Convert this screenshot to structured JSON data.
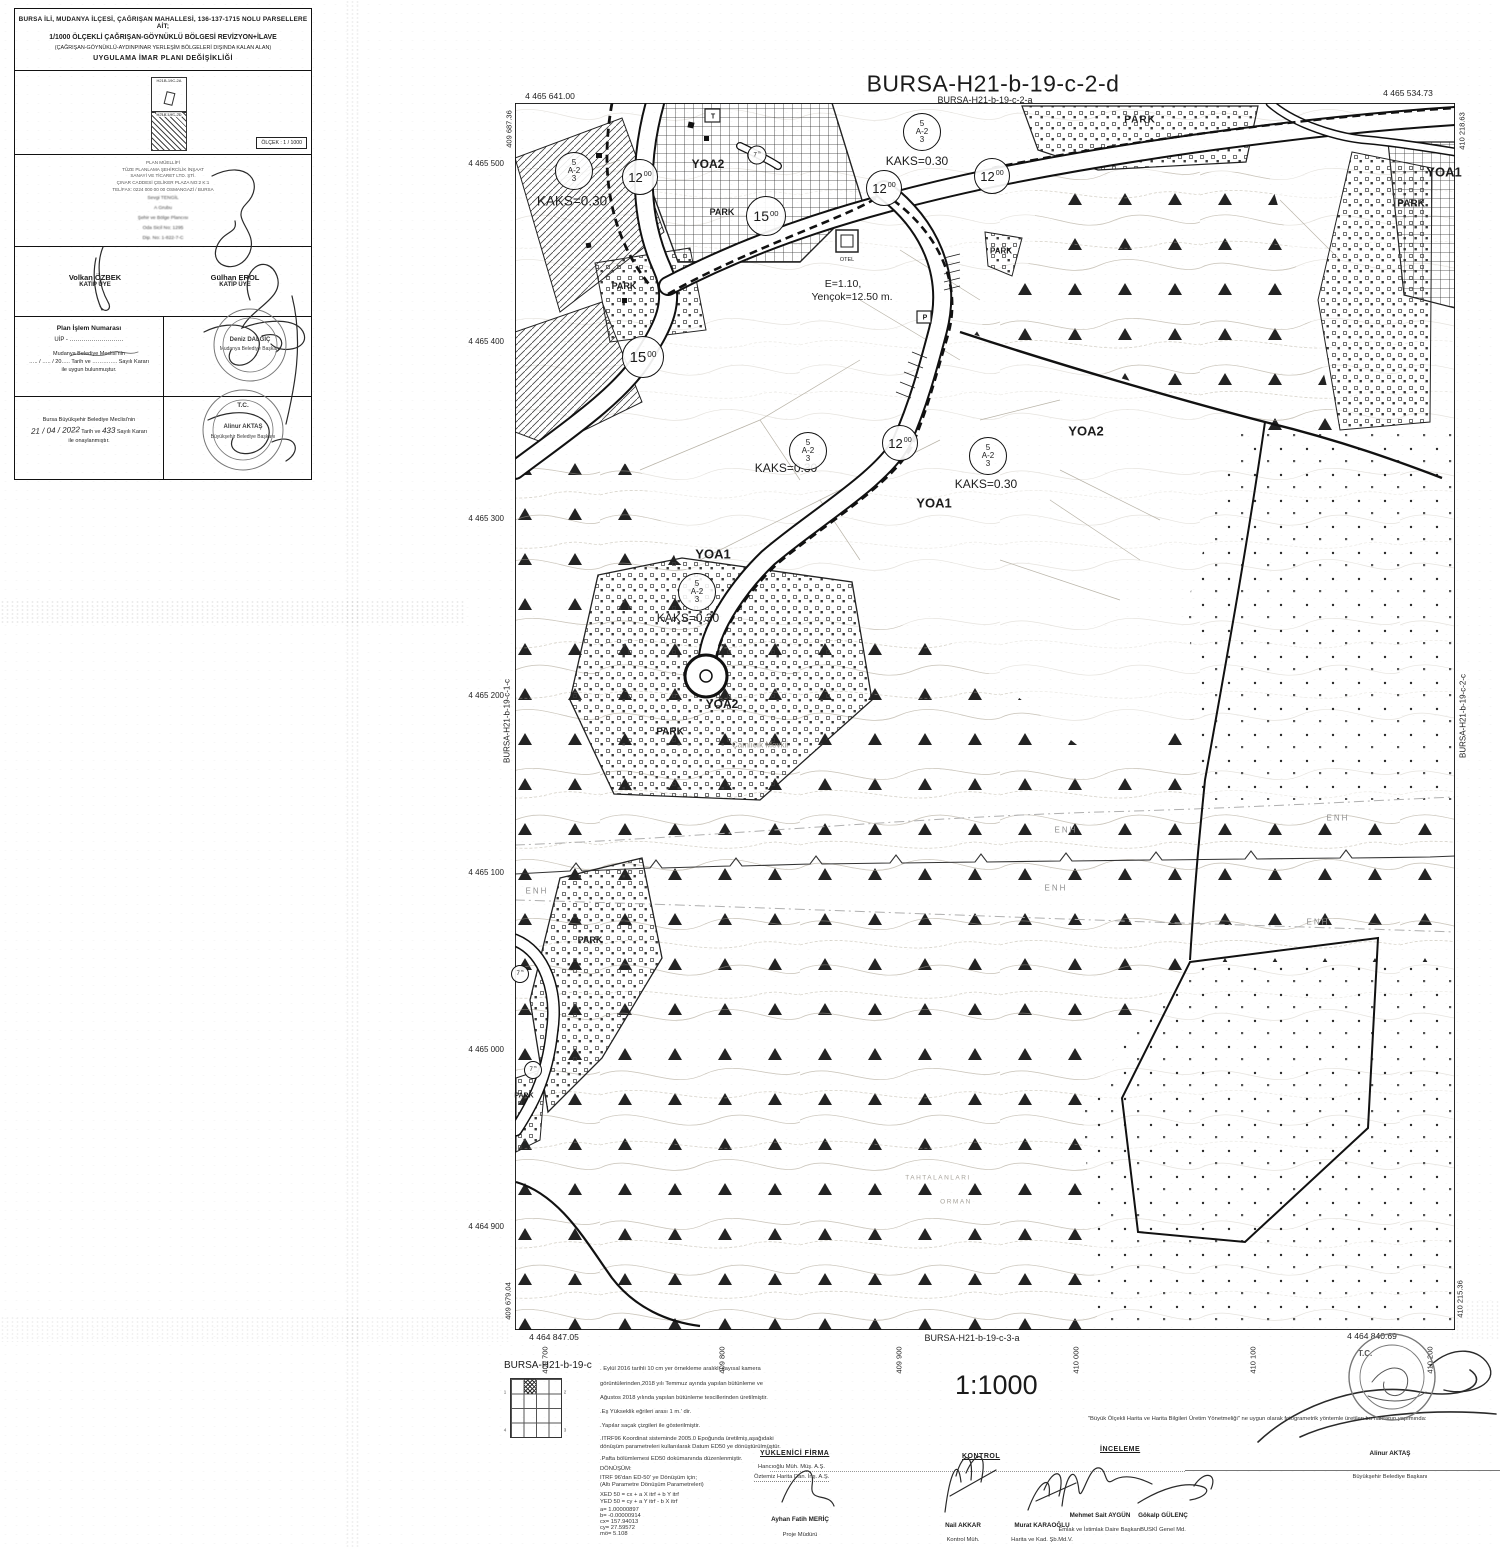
{
  "title_block": {
    "header_lines": [
      "BURSA İLİ, MUDANYA İLÇESİ, ÇAĞRIŞAN MAHALLESİ, 136-137-1715 NOLU PARSELLERE AİT;",
      "1/1000 ÖLÇEKLİ ÇAĞRIŞAN-GÖYNÜKLÜ BÖLGESİ REVİZYON+İLAVE",
      "(ÇAĞRIŞAN-GÖYNÜKLÜ-AYDINPINAR YERLEŞİM BÖLGELERİ DIŞINDA KALAN ALAN)",
      "UYGULAMA İMAR PLANI DEĞİŞİKLİĞİ"
    ],
    "index_labels": [
      "H21B-19C-2A",
      "H21B-19C-2D"
    ],
    "scale_box": "ÖLÇEK : 1 / 1000",
    "author_lines": [
      "PLAN MÜELLİFİ",
      "TÜZE PLANLAMA ŞEHİRCİLİK İNŞAAT",
      "SANAYİ VE TİCARET LTD. ŞTİ.",
      "ÇINAR CADDESİ ÇELİKER PLAZA NO:2 K:1",
      "TEL/FAX: 0224 000 00 00  OSMANGAZİ / BURSA"
    ],
    "author_name_lines": [
      "Sevgi TENGİL",
      "A Grubu",
      "Şehir ve Bölge Plancısı",
      "Oda Sicil No: 1295",
      "Dip. No: 1-822-7-C"
    ],
    "members": [
      {
        "name": "Volkan ÖZBEK",
        "role": "KATİP ÜYE"
      },
      {
        "name": "Gülhan EROL",
        "role": "KATİP ÜYE"
      }
    ],
    "plan_no": {
      "title": "Plan İşlem Numarası",
      "uip": "UİP - ………………………",
      "l1": "Mudanya Belediye Meclisi'nin",
      "l2": "….. / ….. / 20….. Tarih ve ………….. Sayılı Kararı",
      "l3": "ile uygun bulunmuştur."
    },
    "mudanya_stamp": {
      "name": "Deniz DALGIÇ",
      "title": "Mudanya Belediye Başkanı"
    },
    "approval": {
      "l1": "Bursa Büyükşehir Belediye Meclisi'nin",
      "date": "21 / 04 / 2022",
      "mid": "Tarih ve",
      "num": "433",
      "tail": "Sayılı Kararı",
      "l3": "ile onaylanmıştır."
    },
    "bursa_stamp": {
      "tc": "T.C.",
      "name": "Alinur AKTAŞ",
      "title": "Büyükşehir Belediye Başkanı"
    }
  },
  "map": {
    "title": "BURSA-H21-b-19-c-2-d",
    "zone_symbol": {
      "top": "5",
      "mid": "A-2",
      "bot": "3"
    },
    "zone_circles": [
      {
        "x": 574,
        "y": 171
      },
      {
        "x": 922,
        "y": 132
      },
      {
        "x": 808,
        "y": 451
      },
      {
        "x": 988,
        "y": 456
      },
      {
        "x": 697,
        "y": 592
      }
    ],
    "road_circles": [
      {
        "t": "12",
        "sup": "00",
        "x": 640,
        "y": 177,
        "d": 34,
        "fs": 13
      },
      {
        "t": "12",
        "sup": "00",
        "x": 884,
        "y": 188,
        "d": 34,
        "fs": 13
      },
      {
        "t": "12",
        "sup": "00",
        "x": 992,
        "y": 176,
        "d": 34,
        "fs": 13
      },
      {
        "t": "12",
        "sup": "00",
        "x": 900,
        "y": 443,
        "d": 34,
        "fs": 13
      },
      {
        "t": "15",
        "sup": "00",
        "x": 766,
        "y": 216,
        "d": 38,
        "fs": 14
      },
      {
        "t": "15",
        "sup": "00",
        "x": 643,
        "y": 357,
        "d": 40,
        "fs": 15
      },
      {
        "t": "7",
        "sup": "m",
        "x": 757,
        "y": 155,
        "d": 17,
        "fs": 6
      },
      {
        "t": "7",
        "sup": "m",
        "x": 520,
        "y": 974,
        "d": 16,
        "fs": 6
      },
      {
        "t": "7",
        "sup": "m",
        "x": 533,
        "y": 1070,
        "d": 16,
        "fs": 6
      }
    ],
    "left_coords": [
      {
        "t": "4 465 500",
        "y": 164
      },
      {
        "t": "4 465 400",
        "y": 342
      },
      {
        "t": "4 465 300",
        "y": 519
      },
      {
        "t": "4 465 200",
        "y": 696
      },
      {
        "t": "4 465 100",
        "y": 873
      },
      {
        "t": "4 465 000",
        "y": 1050
      },
      {
        "t": "4 464 900",
        "y": 1227
      }
    ],
    "bottom_coords": [
      {
        "t": "409 700",
        "x": 545
      },
      {
        "t": "409 800",
        "x": 722
      },
      {
        "t": "409 900",
        "x": 899
      },
      {
        "t": "410 000",
        "x": 1076
      },
      {
        "t": "410 100",
        "x": 1253
      },
      {
        "t": "410 200",
        "x": 1430
      }
    ],
    "labels": [
      {
        "t": "BURSA-H21-b-19-c-2-a",
        "x": 985,
        "y": 100,
        "fs": 9,
        "n": "adjacent-sheet-top"
      },
      {
        "t": "4 465 641.00",
        "x": 550,
        "y": 96,
        "fs": 8.5,
        "n": "corner-coordinate"
      },
      {
        "t": "4 465 534.73",
        "x": 1408,
        "y": 93,
        "fs": 8.5,
        "n": "corner-coordinate"
      },
      {
        "t": "4 464 847.05",
        "x": 554,
        "y": 1337,
        "fs": 8.5,
        "n": "corner-coordinate"
      },
      {
        "t": "4 464 840.69",
        "x": 1372,
        "y": 1336,
        "fs": 8.5,
        "n": "corner-coordinate"
      },
      {
        "t": "409 687.36",
        "x": 509,
        "y": 129,
        "fs": 7.5,
        "rot": -90,
        "n": "corner-coordinate"
      },
      {
        "t": "410 218.63",
        "x": 1462,
        "y": 131,
        "fs": 7.5,
        "rot": -90,
        "n": "corner-coordinate"
      },
      {
        "t": "409 679.04",
        "x": 508,
        "y": 1301,
        "fs": 7.5,
        "rot": -90,
        "n": "corner-coordinate"
      },
      {
        "t": "410 215.36",
        "x": 1460,
        "y": 1299,
        "fs": 7.5,
        "rot": -90,
        "n": "corner-coordinate"
      },
      {
        "t": "BURSA-H21-b-19-c-1-c",
        "x": 507,
        "y": 721,
        "fs": 8,
        "rot": -90,
        "n": "adjacent-sheet-left"
      },
      {
        "t": "BURSA-H21-b-19-c-2-c",
        "x": 1463,
        "y": 716,
        "fs": 8,
        "rot": -90,
        "n": "adjacent-sheet-right"
      },
      {
        "t": "BURSA-H21-b-19-c-3-a",
        "x": 972,
        "y": 1338,
        "fs": 9,
        "n": "adjacent-sheet-bottom"
      },
      {
        "t": "KAKS=0.30",
        "x": 572,
        "y": 201,
        "fs": 13.5,
        "n": "kaks-note"
      },
      {
        "t": "KAKS=0.30",
        "x": 917,
        "y": 161,
        "fs": 12,
        "n": "kaks-note"
      },
      {
        "t": "KAKS=0.30",
        "x": 786,
        "y": 468,
        "fs": 12,
        "n": "kaks-note"
      },
      {
        "t": "KAKS=0.30",
        "x": 986,
        "y": 484,
        "fs": 12,
        "n": "kaks-note"
      },
      {
        "t": "KAKS=0.30",
        "x": 688,
        "y": 618,
        "fs": 12,
        "n": "kaks-note"
      },
      {
        "t": "YOA1",
        "x": 713,
        "y": 554,
        "fs": 13,
        "b": 1,
        "n": "zone-label"
      },
      {
        "t": "YOA1",
        "x": 934,
        "y": 503,
        "fs": 13,
        "b": 1,
        "n": "zone-label"
      },
      {
        "t": "YOA1",
        "x": 1444,
        "y": 172,
        "fs": 13,
        "b": 1,
        "n": "zone-label"
      },
      {
        "t": "YOA2",
        "x": 708,
        "y": 164,
        "fs": 12,
        "b": 1,
        "n": "zone-label"
      },
      {
        "t": "YOA2",
        "x": 1086,
        "y": 431,
        "fs": 13,
        "b": 1,
        "n": "zone-label"
      },
      {
        "t": "YOA2",
        "x": 722,
        "y": 704,
        "fs": 12,
        "b": 1,
        "n": "zone-label"
      },
      {
        "t": "E=1.10,",
        "x": 843,
        "y": 284,
        "fs": 10.5,
        "n": "plan-parameter"
      },
      {
        "t": "Yençok=12.50 m.",
        "x": 852,
        "y": 297,
        "fs": 10.5,
        "n": "plan-parameter"
      },
      {
        "t": "PARK",
        "x": 1140,
        "y": 120,
        "fs": 10,
        "b": 1,
        "ls": 1,
        "n": "park-label"
      },
      {
        "t": "PARK",
        "x": 722,
        "y": 212,
        "fs": 9,
        "b": 1,
        "n": "park-label"
      },
      {
        "t": "PARK",
        "x": 624,
        "y": 286,
        "fs": 9,
        "b": 1,
        "n": "park-label"
      },
      {
        "t": "PARK",
        "x": 1001,
        "y": 251,
        "fs": 8,
        "b": 1,
        "n": "park-label"
      },
      {
        "t": "PARK",
        "x": 1411,
        "y": 204,
        "fs": 10,
        "b": 1,
        "n": "park-label"
      },
      {
        "t": "PARK",
        "x": 670,
        "y": 732,
        "fs": 10,
        "b": 1,
        "n": "park-label"
      },
      {
        "t": "PARK",
        "x": 590,
        "y": 940,
        "fs": 9,
        "b": 1,
        "n": "park-label"
      },
      {
        "t": "PARK",
        "x": 524,
        "y": 1096,
        "fs": 7,
        "b": 1,
        "n": "park-label"
      },
      {
        "t": "ENH",
        "x": 1066,
        "y": 830,
        "fs": 8,
        "c": "#8f8f8f",
        "ls": 2,
        "n": "enh-powerline"
      },
      {
        "t": "ENH",
        "x": 1338,
        "y": 818,
        "fs": 8,
        "c": "#8f8f8f",
        "ls": 2,
        "n": "enh-powerline"
      },
      {
        "t": "ENH",
        "x": 1056,
        "y": 888,
        "fs": 8,
        "c": "#8f8f8f",
        "ls": 2,
        "n": "enh-powerline"
      },
      {
        "t": "ENH",
        "x": 1318,
        "y": 922,
        "fs": 8,
        "c": "#8f8f8f",
        "ls": 2,
        "n": "enh-powerline"
      },
      {
        "t": "ENH",
        "x": 537,
        "y": 891,
        "fs": 8,
        "c": "#8f8f8f",
        "ls": 2,
        "n": "enh-powerline"
      },
      {
        "t": "OTEL",
        "x": 847,
        "y": 260,
        "fs": 5.5,
        "n": "otel-label"
      },
      {
        "t": "T",
        "x": 713,
        "y": 117,
        "fs": 7,
        "b": 1,
        "n": "trafo-label"
      },
      {
        "t": "P",
        "x": 925,
        "y": 318,
        "fs": 7,
        "b": 1,
        "n": "parking-label"
      },
      {
        "t": "TAHTALANLARI",
        "x": 938,
        "y": 1178,
        "fs": 6.5,
        "c": "#a8a49c",
        "ls": 1.5,
        "n": "locality-name"
      },
      {
        "t": "ORMAN",
        "x": 956,
        "y": 1202,
        "fs": 6.5,
        "c": "#a8a49c",
        "ls": 1.5,
        "n": "locality-name"
      },
      {
        "t": "Çamlıcık Mevkii",
        "x": 760,
        "y": 745,
        "fs": 8,
        "c": "#9a968e",
        "n": "locality-name"
      },
      {
        "t": "1",
        "x": 505,
        "y": 1392,
        "fs": 4.5,
        "c": "#555",
        "n": "legend-grid-number"
      },
      {
        "t": "2",
        "x": 565,
        "y": 1392,
        "fs": 4.5,
        "c": "#555",
        "n": "legend-grid-number"
      },
      {
        "t": "4",
        "x": 505,
        "y": 1430,
        "fs": 4.5,
        "c": "#555",
        "n": "legend-grid-number"
      },
      {
        "t": "3",
        "x": 565,
        "y": 1430,
        "fs": 4.5,
        "c": "#555",
        "n": "legend-grid-number"
      }
    ]
  },
  "legend": {
    "sheet_label": "BURSA-H21-b-19-c",
    "scale_text": "1:1000",
    "production_note": "\"Büyük Ölçekli Harita ve Harita Bilgileri Üretim Yönetmeliği\" ne uygun olarak fotogrametrik yöntemle üretilen bu haritanın yapımında:",
    "notes": [
      {
        "t": ". Eylül 2016 tarihli 10 cm yer örnekleme aralıklı sayısal kamera",
        "y": 1366
      },
      {
        "t": "görüntülerinden,2018 yılı Temmuz ayında yapılan bütünleme ve",
        "y": 1381
      },
      {
        "t": "Ağustos 2018 yılında yapılan bütünleme tescillerinden üretilmiştir.",
        "y": 1395
      },
      {
        "t": ".Eş Yükseklik eğrileri arası 1 m.' dir.",
        "y": 1409
      },
      {
        "t": ".Yapılar saçak çizgileri ile gösterilmiştir.",
        "y": 1423
      },
      {
        "t": ".ITRF96 Koordinat sisteminde 2005.0 Epoğunda üretilmiş,aşağıdaki",
        "y": 1436
      },
      {
        "t": "dönüşüm parametreleri kullanılarak Datum ED50 ye dönüştürülmüştür.",
        "y": 1444
      },
      {
        "t": ".Pafta bölümlemesi ED50 dokümanında düzenlenmiştir.",
        "y": 1456
      },
      {
        "t": "DÖNÜŞÜM:",
        "y": 1466
      },
      {
        "t": "ITRF 96'dan ED-50' ye Dönüşüm için;",
        "y": 1475
      },
      {
        "t": "(Altı Parametre Dönüşüm Parametreleri)",
        "y": 1482
      },
      {
        "t": "XED 50 = cx + a X itrf + b Y itrf",
        "y": 1492
      },
      {
        "t": "YED 50 = cy + a Y itrf - b X itrf",
        "y": 1499
      },
      {
        "t": "a=  1.00000897",
        "y": 1507
      },
      {
        "t": "b= -0.00000914",
        "y": 1513
      },
      {
        "t": "cx= 157.94013",
        "y": 1519
      },
      {
        "t": "cy= 27.59572",
        "y": 1525
      },
      {
        "t": "mö= 5.108",
        "y": 1531
      }
    ],
    "headers": {
      "yuklenici": "YÜKLENİCİ FİRMA",
      "kontrol": "KONTROL",
      "inceleme": "İNCELEME"
    },
    "firm_lines": [
      "Hancıoğlu Müh. Müş. A.Ş.",
      "Öztemiz Harita Dan. İnş. A.Ş."
    ],
    "signers": [
      {
        "name": "Ayhan Fatih MERİÇ",
        "title": "Proje Müdürü",
        "x": 800,
        "ny": 1516,
        "ty": 1532
      },
      {
        "name": "Nail AKKAR",
        "title": "Kontrol Müh.",
        "x": 963,
        "ny": 1522,
        "ty": 1537
      },
      {
        "name": "Murat KARAOĞLU",
        "title": "Harita ve Kad. Şb.Md.V.",
        "x": 1042,
        "ny": 1522,
        "ty": 1537
      },
      {
        "name": "Mehmet Sait AYGÜN",
        "title": "Emlak ve İstimlak Daire Başkanı",
        "x": 1100,
        "ny": 1512,
        "ty": 1527
      },
      {
        "name": "Gökalp GÜLENÇ",
        "title": "BUSKİ Genel Md.",
        "x": 1163,
        "ny": 1512,
        "ty": 1527
      },
      {
        "name": "Alinur AKTAŞ",
        "title": "Büyükşehir Belediye Başkanı",
        "x": 1390,
        "ny": 1450,
        "ty": 1474
      }
    ],
    "stamp_tc": "T.C."
  }
}
